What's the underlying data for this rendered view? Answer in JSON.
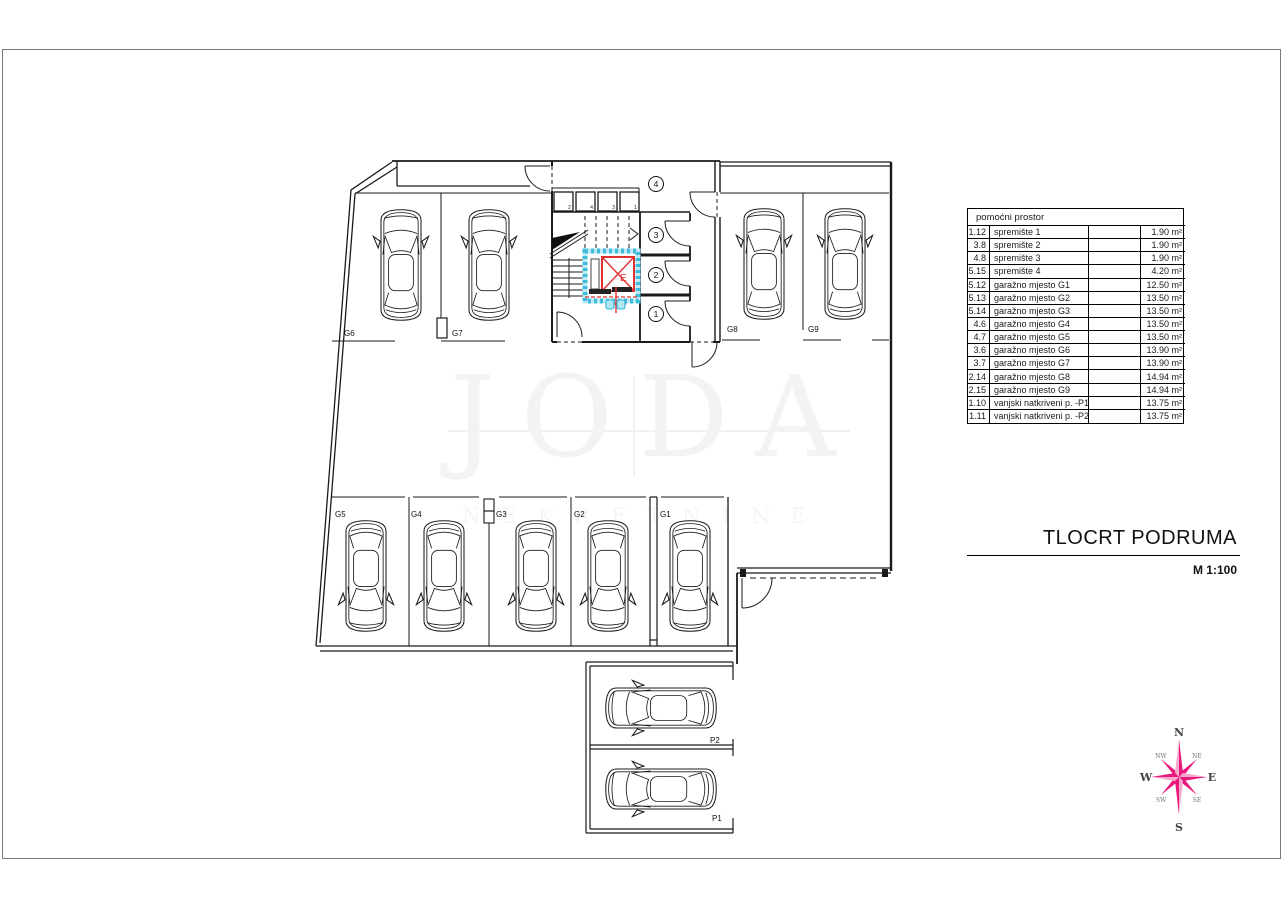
{
  "title_block": {
    "title": "TLOCRT PODRUMA",
    "scale": "M 1:100"
  },
  "watermark": {
    "line1": "JODA",
    "line2": "NEKRETNINE"
  },
  "table": {
    "header": "pomoćni prostor",
    "rows": [
      {
        "id": "1.12",
        "name": "spremište 1",
        "area": "1.90 m²"
      },
      {
        "id": "3.8",
        "name": "spremište 2",
        "area": "1.90 m²"
      },
      {
        "id": "4.8",
        "name": "spremište 3",
        "area": "1.90 m²"
      },
      {
        "id": "5.15",
        "name": "spremište 4",
        "area": "4.20 m²"
      },
      {
        "id": "5.12",
        "name": "garažno mjesto G1",
        "area": "12.50 m²"
      },
      {
        "id": "5.13",
        "name": "garažno mjesto G2",
        "area": "13.50 m²"
      },
      {
        "id": "5.14",
        "name": "garažno mjesto G3",
        "area": "13.50 m²"
      },
      {
        "id": "4.6",
        "name": "garažno mjesto G4",
        "area": "13.50 m²"
      },
      {
        "id": "4.7",
        "name": "garažno mjesto G5",
        "area": "13.50 m²"
      },
      {
        "id": "3.6",
        "name": "garažno mjesto G6",
        "area": "13.90 m²"
      },
      {
        "id": "3.7",
        "name": "garažno mjesto G7",
        "area": "13.90 m²"
      },
      {
        "id": "2.14",
        "name": "garažno mjesto G8",
        "area": "14.94 m²"
      },
      {
        "id": "2.15",
        "name": "garažno mjesto G9",
        "area": "14.94 m²"
      },
      {
        "id": "1.10",
        "name": "vanjski natkriveni p. -P1",
        "area": "13.75 m²"
      },
      {
        "id": "1.11",
        "name": "vanjski natkriveni p. -P2",
        "area": "13.75 m²"
      }
    ]
  },
  "plan": {
    "parking_labels": {
      "g1": "G1",
      "g2": "G2",
      "g3": "G3",
      "g4": "G4",
      "g5": "G5",
      "g6": "G6",
      "g7": "G7",
      "g8": "G8",
      "g9": "G9",
      "p1": "P1",
      "p2": "P2"
    },
    "room_numbers": [
      "1",
      "2",
      "3",
      "4"
    ],
    "storage_numbers": [
      "2",
      "4",
      "3",
      "1"
    ],
    "elevator_label": "E"
  },
  "compass": {
    "n": "N",
    "ne": "NE",
    "e": "E",
    "se": "SE",
    "s": "S",
    "sw": "SW",
    "w": "W",
    "nw": "NW"
  },
  "colors": {
    "wall": "#1a1a1a",
    "elevator_red": "#e03131",
    "hatch_cyan": "#3fbcdc",
    "compass_pink": "#e8197d",
    "page_border": "#7a7a7a"
  }
}
